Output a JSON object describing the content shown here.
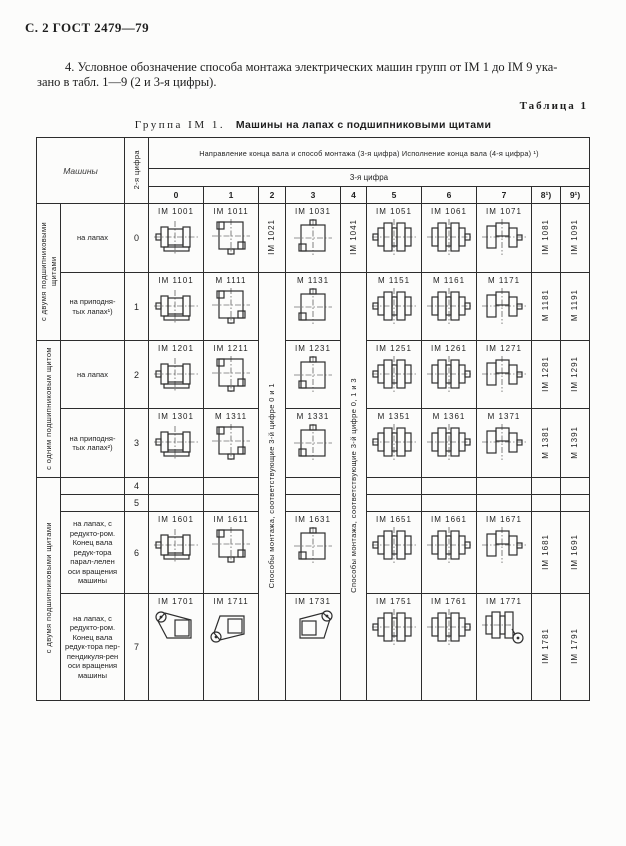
{
  "page": {
    "page_header": "С. 2 ГОСТ 2479—79",
    "paragraph_line1": "4. Условное обозначение способа  монтажа электрических машин групп от IM 1 до IM 9 ука-",
    "paragraph_line2": "зано в табл. 1—9 (2 и 3-я цифры).",
    "table_label": "Таблица 1",
    "table_title_prefix": "Группа IM 1.",
    "table_title_main": "Машины на лапах с подшипниковыми щитами"
  },
  "table": {
    "corner_header": "Машины",
    "digit_header": "2-я цифра",
    "span_header": "Направление конца вала и способ монтажа (3-я цифра) Исполнение конца вала (4-я цифра) ¹)",
    "sub_header": "3-я цифра",
    "col_numbers": [
      "0",
      "1",
      "2",
      "3",
      "4",
      "5",
      "6",
      "7",
      "8¹)",
      "9¹)"
    ],
    "vertical_notes": [
      {
        "col": "2",
        "text": "Способы монтажа, соответствующие 3-й цифре 0 и 1"
      },
      {
        "col": "4",
        "text": "Способы монтажа, соответствующие 3-й цифре 0, 1 и 3"
      }
    ],
    "groups": [
      {
        "label": "с двумя подшипниковыми щитами",
        "rows": "0–1"
      },
      {
        "label": "с одним подшипниковым щитом",
        "rows": "2–3"
      },
      {
        "label": "с двумя подшипниковыми щитами",
        "rows": "6–7"
      }
    ],
    "rows": [
      {
        "digit": "0",
        "desc": "на лапах",
        "codes": [
          "IM 1001",
          "IM 1011",
          "IM 1021",
          "IM 1031",
          "IM 1041",
          "IM 1051",
          "IM 1061",
          "IM 1071",
          "IM 1081",
          "IM 1091"
        ],
        "icons": {
          "0": "motor-a",
          "1": "motor-b",
          "3": "motor-c",
          "5": "motor-d",
          "6": "motor-e",
          "7": "motor-f"
        }
      },
      {
        "digit": "1",
        "desc": "на приподня-тых лапах¹)",
        "codes": [
          "IM 1101",
          "M 1111",
          "",
          "M 1131",
          "",
          "M 1151",
          "M 1161",
          "M 1171",
          "M 1181",
          "M 1191"
        ],
        "icons": {
          "0": "motor-a",
          "1": "motor-b",
          "3": "motor-c",
          "5": "motor-d",
          "6": "motor-e",
          "7": "motor-f"
        }
      },
      {
        "digit": "2",
        "desc": "на лапах",
        "codes": [
          "IM 1201",
          "IM 1211",
          "",
          "IM 1231",
          "",
          "IM 1251",
          "IM 1261",
          "IM 1271",
          "IM 1281",
          "IM 1291"
        ],
        "icons": {
          "0": "motor-a",
          "1": "motor-b",
          "3": "motor-c",
          "5": "motor-d",
          "6": "motor-e",
          "7": "motor-f"
        }
      },
      {
        "digit": "3",
        "desc": "на приподня-тых лапах²)",
        "codes": [
          "IM 1301",
          "M 1311",
          "",
          "M 1331",
          "",
          "M 1351",
          "M 1361",
          "M 1371",
          "M 1381",
          "M 1391"
        ],
        "icons": {
          "0": "motor-a",
          "1": "motor-b",
          "3": "motor-c",
          "5": "motor-d",
          "6": "motor-e",
          "7": "motor-f"
        }
      },
      {
        "digit": "4",
        "desc": "",
        "codes": [
          "",
          "",
          "",
          "",
          "",
          "",
          "",
          "",
          "",
          ""
        ],
        "icons": {}
      },
      {
        "digit": "5",
        "desc": "",
        "codes": [
          "",
          "",
          "",
          "",
          "",
          "",
          "",
          "",
          "",
          ""
        ],
        "icons": {}
      },
      {
        "digit": "6",
        "desc": "на лапах, с редукто-ром. Конец вала редук-тора парал-лелен оси вращения машины",
        "codes": [
          "IM 1601",
          "IM 1611",
          "",
          "IM 1631",
          "",
          "IM 1651",
          "IM 1661",
          "IM 1671",
          "IM 1681",
          "IM 1691"
        ],
        "icons": {
          "0": "motor-a",
          "1": "motor-b",
          "3": "motor-c",
          "5": "motor-d",
          "6": "motor-e",
          "7": "motor-f"
        }
      },
      {
        "digit": "7",
        "desc": "на лапах, с редукто-ром. Конец вала редук-тора пер-пендикуля-рен оси вращения машины",
        "codes": [
          "IM 1701",
          "IM 1711",
          "",
          "IM 1731",
          "",
          "IM 1751",
          "IM 1761",
          "IM 1771",
          "IM 1781",
          "IM 1791"
        ],
        "icons": {
          "0": "gear-a",
          "1": "gear-b",
          "3": "gear-c",
          "5": "motor-d",
          "6": "motor-e",
          "7": "gear-d"
        }
      }
    ]
  },
  "colors": {
    "ink": "#1e1e1e",
    "border": "#2d2d2d",
    "paper": "#fcfcfb"
  }
}
